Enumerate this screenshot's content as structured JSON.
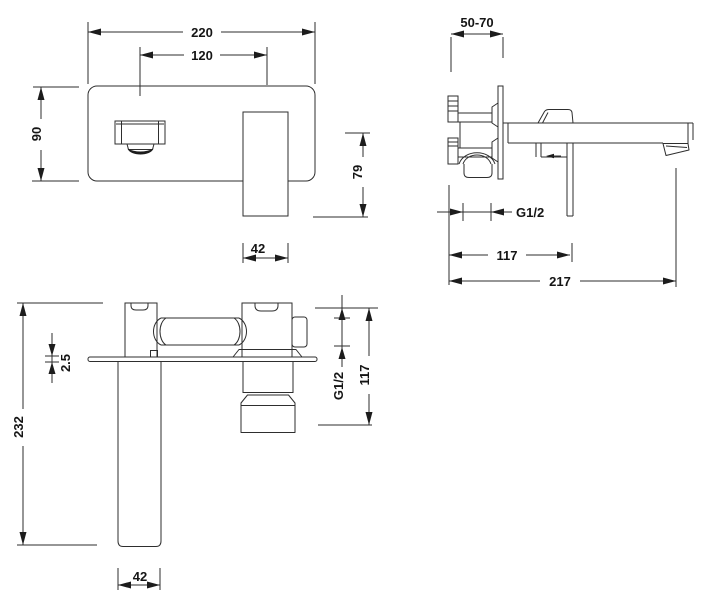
{
  "drawing": {
    "front": {
      "overall_width": "220",
      "spout_to_handle": "120",
      "plate_height": "90",
      "spout_drop": "79",
      "handle_width": "42"
    },
    "side": {
      "wall_thickness_range": "50-70",
      "thread_size": "G1/2",
      "handle_distance": "117",
      "total_reach": "217"
    },
    "plan": {
      "overall_length": "232",
      "plate_thickness": "2.5",
      "connection_thread": "G1/2",
      "body_depth": "117",
      "spout_width": "42"
    }
  }
}
